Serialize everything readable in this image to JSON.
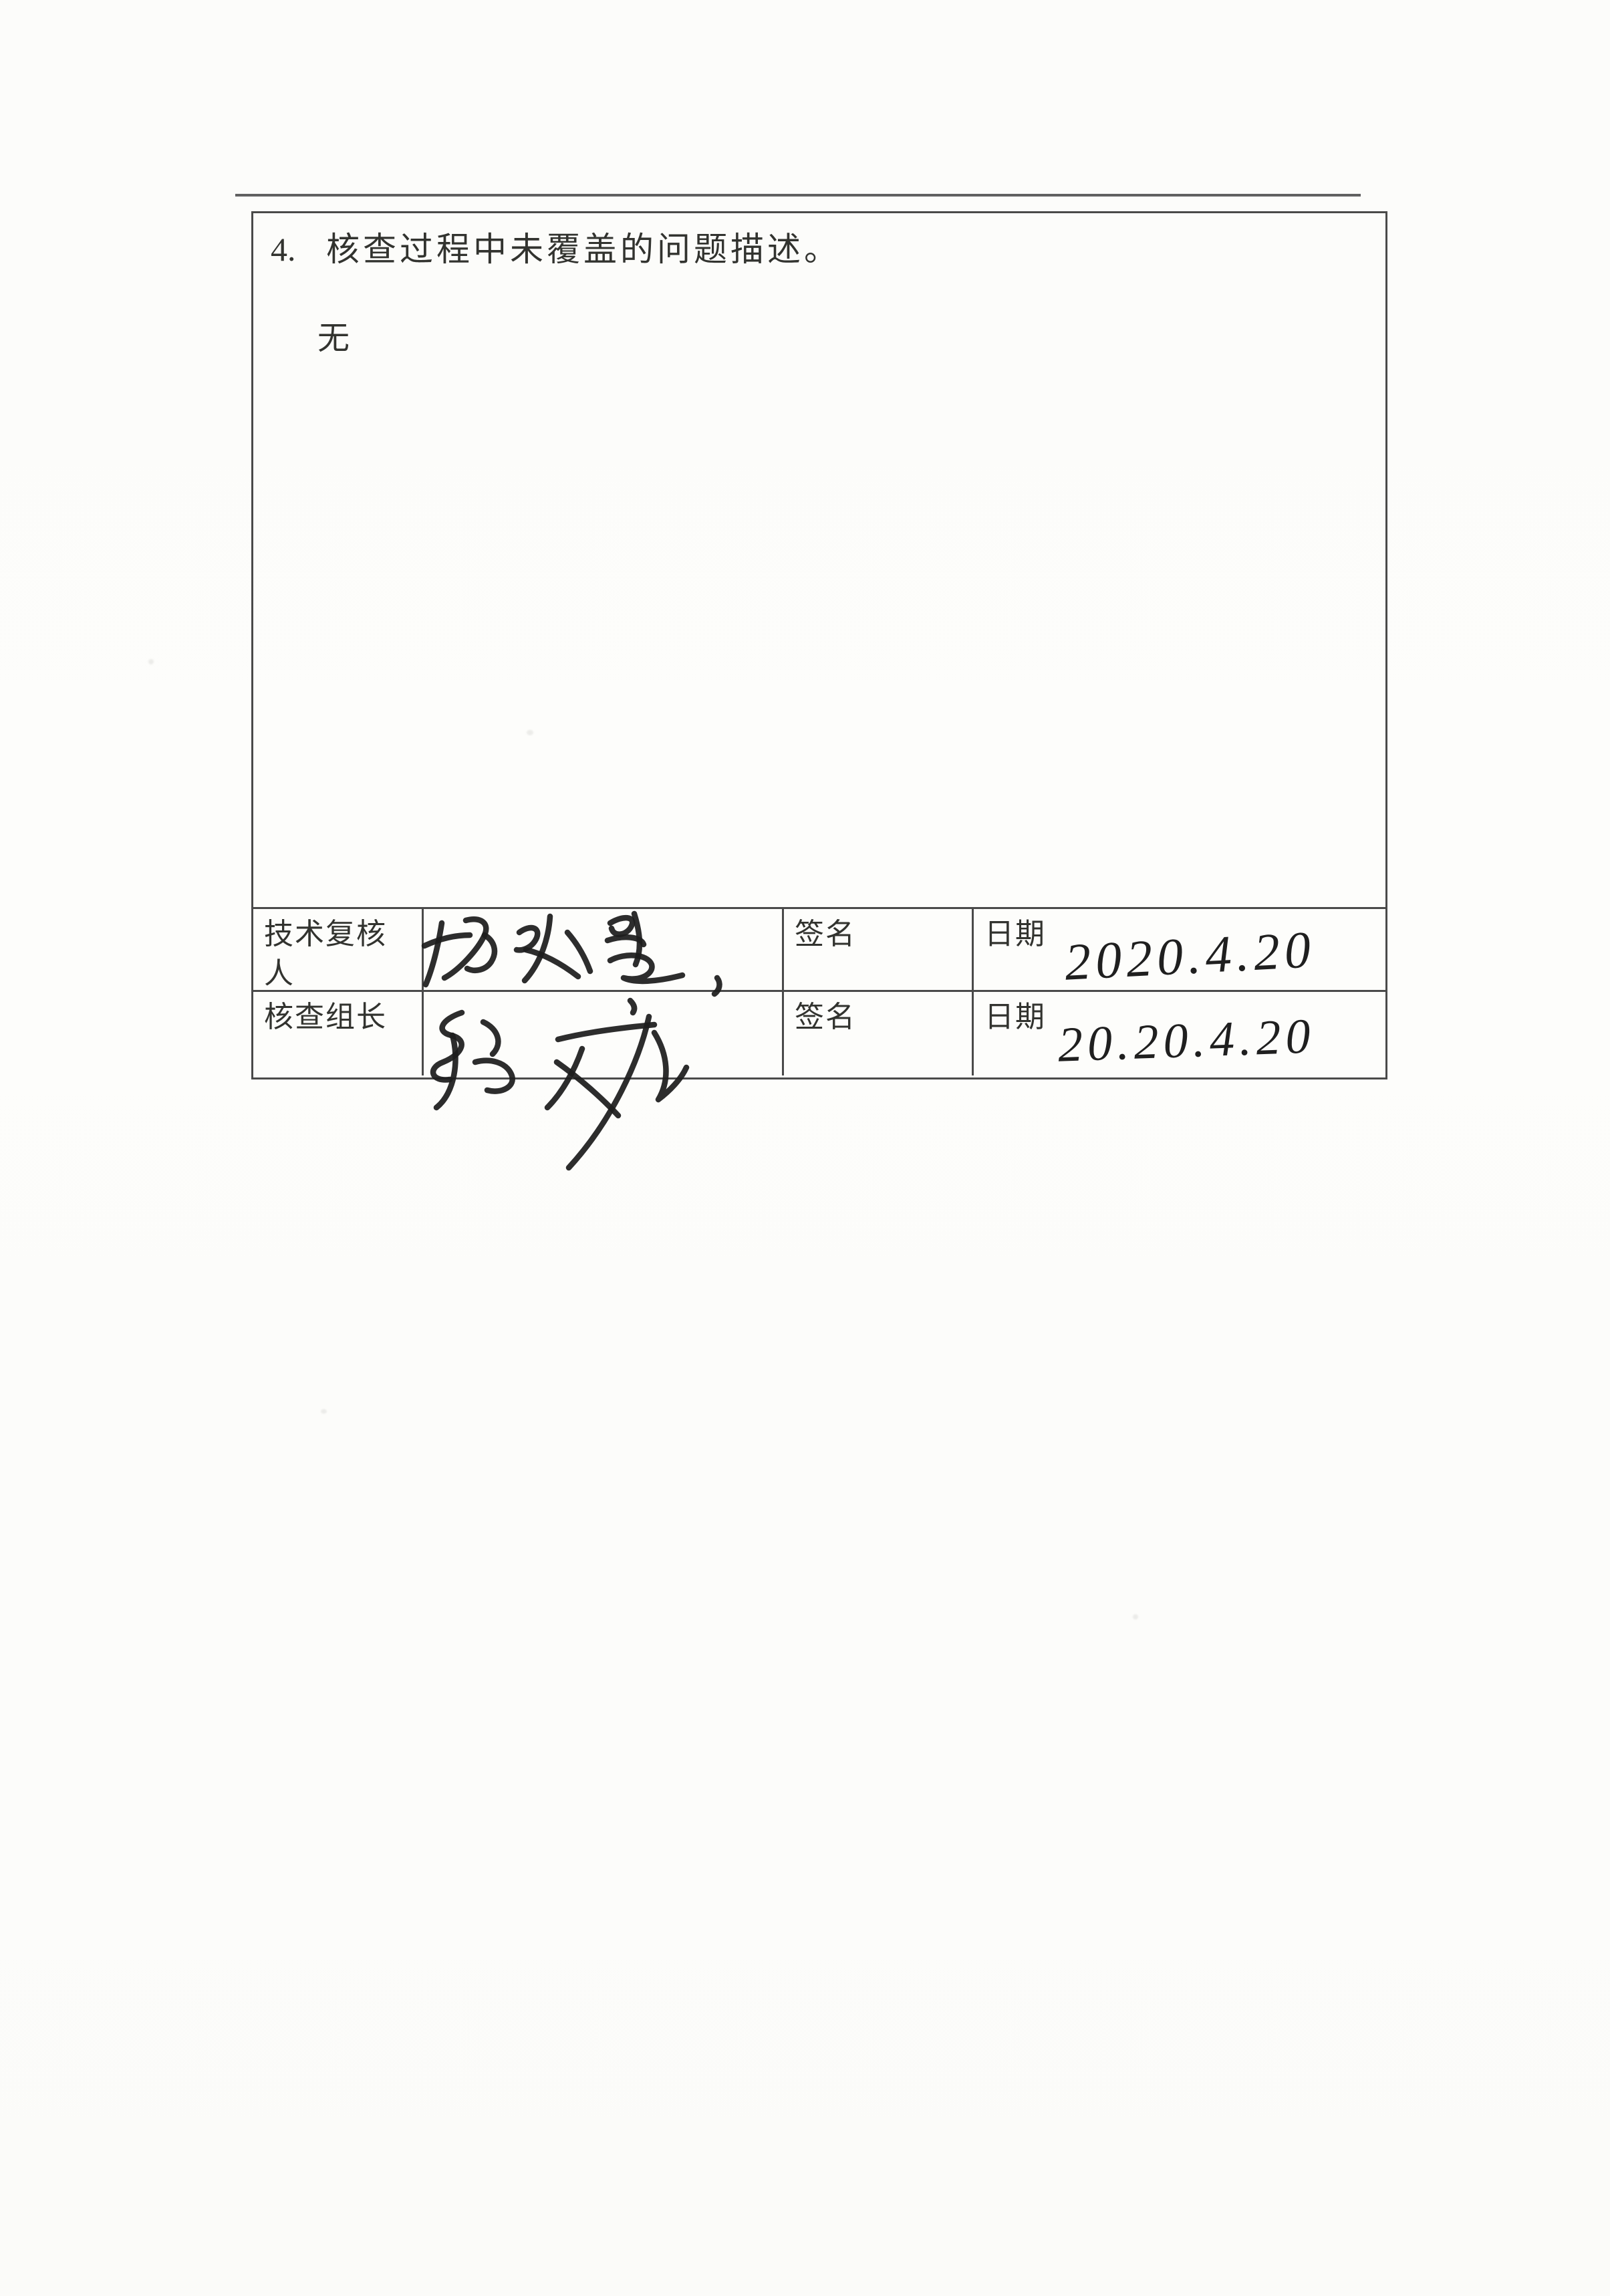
{
  "document": {
    "section_number": "4.",
    "section_title": "核查过程中未覆盖的问题描述。",
    "section_body": "无",
    "signoff": {
      "rows": [
        {
          "role": "技术复核人",
          "signature_name": "杨永慧",
          "sign_label": "签名",
          "date_label": "日期",
          "date_value": "2020.4.20"
        },
        {
          "role": "核查组长",
          "signature_name": "张斌",
          "sign_label": "签名",
          "date_label": "日期",
          "date_value": "20.20.4.20"
        }
      ]
    },
    "colors": {
      "paper": "#fcfcfa",
      "rule_line": "#4a4a4a",
      "print_ink": "#32332f",
      "pen_ink": "#1d1d1d"
    }
  }
}
